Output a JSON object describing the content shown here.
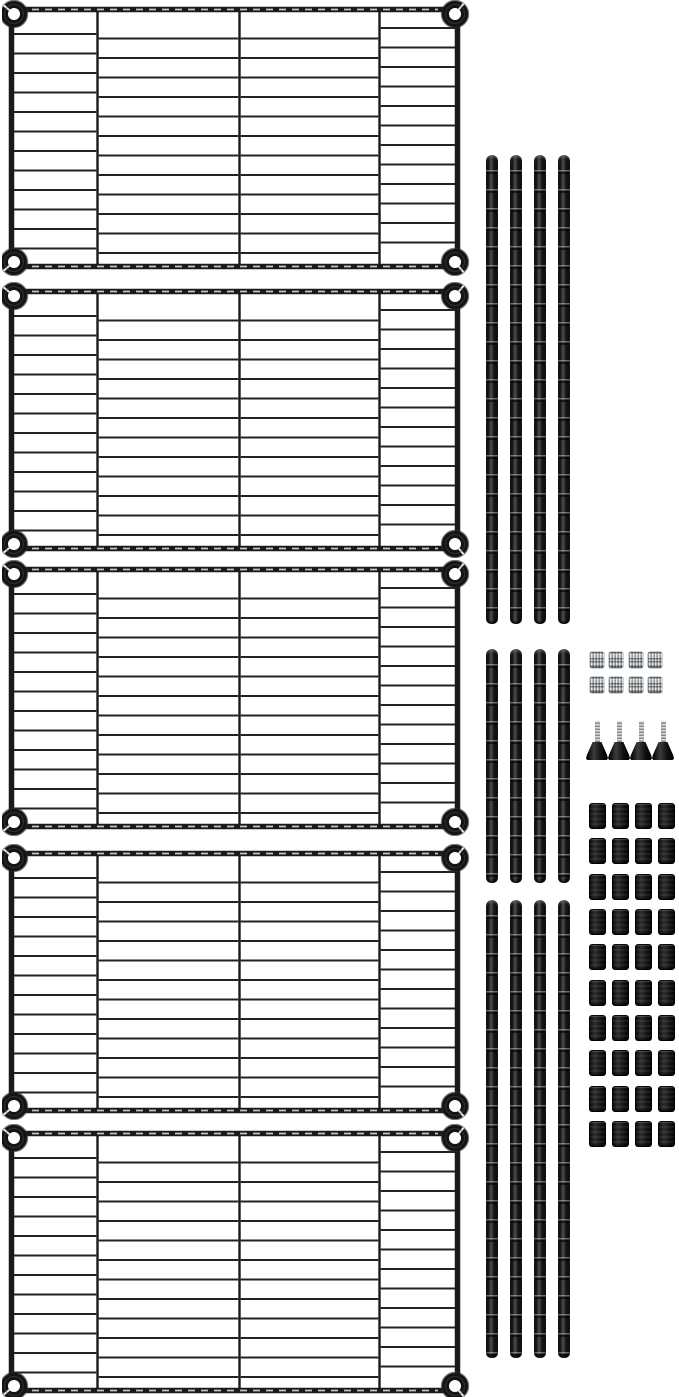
{
  "meta": {
    "type": "product-photo",
    "subject": "5-tier black wire shelving unit, unassembled parts kit",
    "background_color": "#ffffff"
  },
  "palette": {
    "wire_black": "#1a1a1a",
    "wire_highlight": "#4e4e4e",
    "chrome_light": "#e6e9ea",
    "chrome_dark": "#878c90",
    "plastic_black": "#0d0d0d",
    "white": "#ffffff"
  },
  "parts": {
    "shelves": {
      "label": "wire shelf with corner collars",
      "count": 5,
      "columns": 4,
      "corner_collars_each": 4,
      "wire_rows_per_column": 12
    },
    "pole_groups": [
      {
        "label": "pole section - upper group (long)",
        "count": 4,
        "length": "long"
      },
      {
        "label": "pole section - middle group (short)",
        "count": 4,
        "length": "short"
      },
      {
        "label": "pole section - lower group (long)",
        "count": 4,
        "length": "long"
      }
    ],
    "couplers": {
      "label": "knurled chrome coupling nut",
      "count": 8,
      "rows": 2,
      "columns": 4
    },
    "leveling_feet": {
      "label": "leveling foot with threaded stud",
      "count": 4
    },
    "sleeve_clips": {
      "label": "split sleeve shelf clip",
      "count": 40,
      "rows": 10,
      "columns": 4
    }
  }
}
